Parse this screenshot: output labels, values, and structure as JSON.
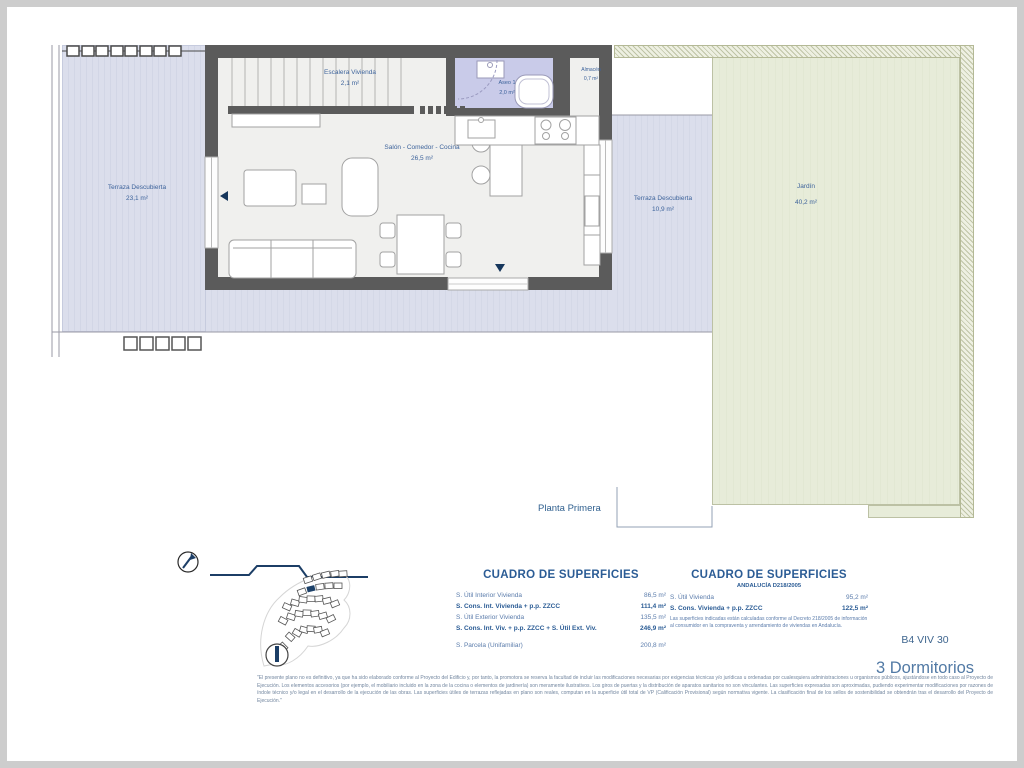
{
  "floor_label": "Planta Primera",
  "rooms": {
    "terraza_izq": {
      "name": "Terraza Descubierta",
      "area": "23,1 m²"
    },
    "escalera": {
      "name": "Escalera Vivienda",
      "area": "2,1 m²"
    },
    "aseo": {
      "name": "Aseo 1",
      "area": "2,0 m²"
    },
    "almacen": {
      "name": "Almacén",
      "area": "0,7 m²"
    },
    "salon": {
      "name": "Salón - Comedor - Cocina",
      "area": "26,5 m²"
    },
    "terraza_der": {
      "name": "Terraza Descubierta",
      "area": "10,9 m²"
    },
    "jardin": {
      "name": "Jardín",
      "area": "40,2 m²"
    }
  },
  "tables": {
    "left": {
      "title": "CUADRO DE SUPERFICIES",
      "rows": [
        {
          "label": "S. Útil Interior Vivienda",
          "value": "86,5 m²",
          "bold": false
        },
        {
          "label": "S. Cons. Int. Vivienda + p.p. ZZCC",
          "value": "111,4 m²",
          "bold": true
        },
        {
          "label": "S. Útil Exterior Vivienda",
          "value": "135,5 m²",
          "bold": false
        },
        {
          "label": "S. Cons. Int. Viv. + p.p. ZZCC + S. Útil Ext. Viv.",
          "value": "246,9 m²",
          "bold": true
        },
        {
          "label": "S. Parcela (Unifamiliar)",
          "value": "200,8 m²",
          "bold": false
        }
      ]
    },
    "right": {
      "title": "CUADRO DE SUPERFICIES",
      "subtitle": "ANDALUCÍA D218/2005",
      "rows": [
        {
          "label": "S. Útil Vivienda",
          "value": "95,2 m²",
          "bold": false
        },
        {
          "label": "S. Cons. Vivienda + p.p. ZZCC",
          "value": "122,5 m²",
          "bold": true
        }
      ],
      "note": "Las superficies indicadas están calculadas conforme al Decreto 218/2005 de información al consumidor en la compraventa y arrendamiento de viviendas en Andalucía."
    }
  },
  "unit": {
    "code": "B4 VIV 30",
    "type": "3 Dormitorios"
  },
  "disclaimer": "\"El presente plano no es definitivo, ya que ha sido elaborado conforme al Proyecto del Edificio y, por tanto, la promotora se reserva la facultad de incluir las modificaciones necesarias por exigencias técnicas y/o jurídicas u ordenadas por cualesquiera administraciones u organismos públicos, ajustándose en todo caso al Proyecto de Ejecución. Los elementos accesorios (por ejemplo, el mobiliario incluido en la zona de la cocina o elementos de jardinería) son meramente ilustrativos. Los giros de puertas y la distribución de aparatos sanitarios no son vinculantes. Las superficies expresadas son aproximadas, pudiendo experimentar modificaciones por razones de índole técnico y/o legal en el desarrollo de la ejecución de las obras. Las superficies útiles de terrazas reflejadas en plano son reales, computan en la superficie útil total de VP (Calificación Provisional) según normativa vigente. La clasificación final de los sellos de sostenibilidad se obtendrán tras el desarrollo del Proyecto de Ejecución.\"",
  "icons": {
    "north_arrow": "compass-circle-with-needle",
    "section_marker": "stepped-section-line",
    "site_plan": "development-site-minimap"
  },
  "colors": {
    "accent_blue": "#2b5c95",
    "label_blue": "#3d639b",
    "wall_gray": "#5b5b5b",
    "terrace_lavender": "#d9dcea",
    "aseo_lavender": "#c9cbe9",
    "garden_green": "#e7ecd9",
    "hatch_olive": "#bfc4a6"
  }
}
